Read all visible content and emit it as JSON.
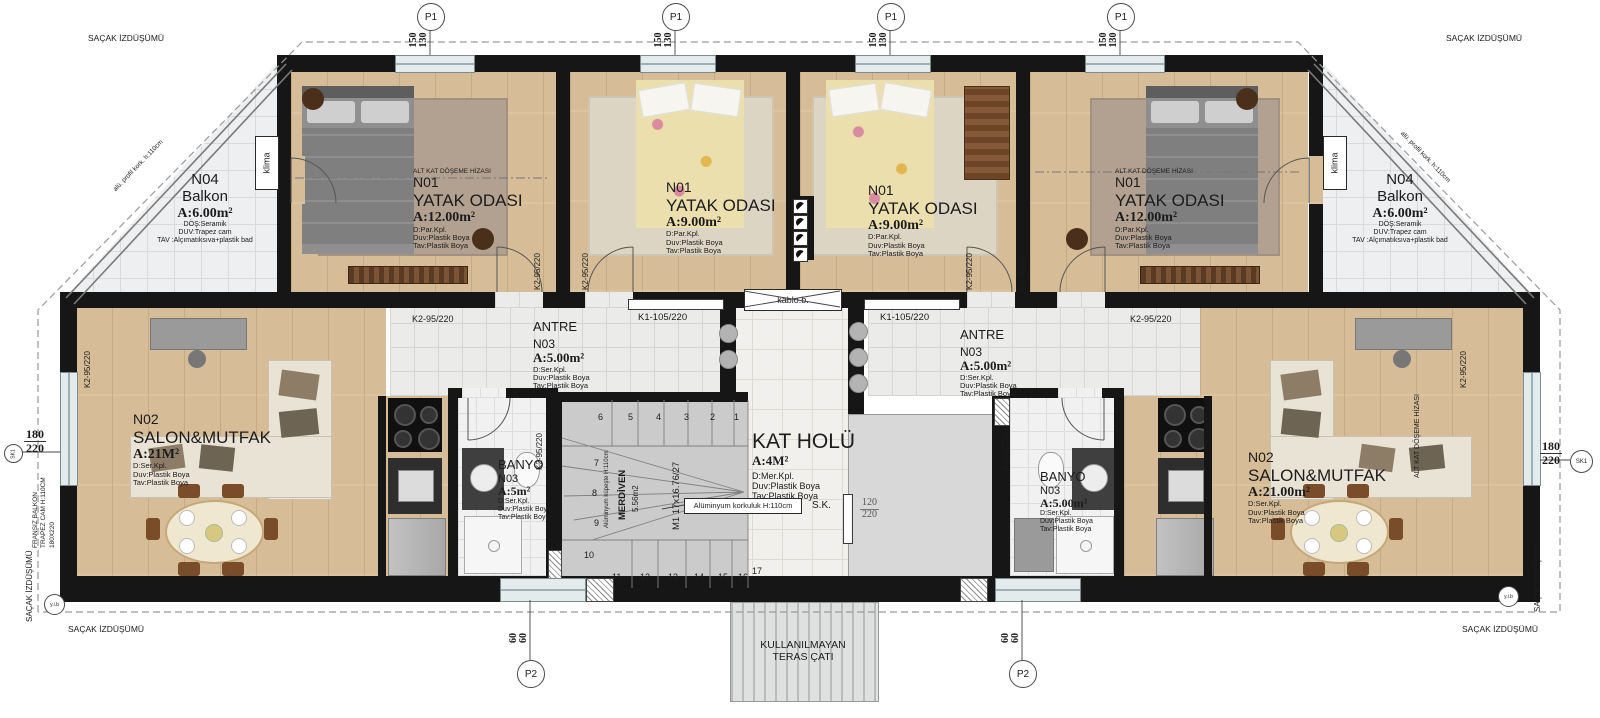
{
  "colors": {
    "wall": "#161616",
    "wood_floor": "#d6bd97",
    "tile": "#edeff0",
    "stair_gray": "#cbcbcb",
    "window": "#e4ebed"
  },
  "eave_label": "SAÇAK İZDÜŞÜMÜ",
  "markers": {
    "p1": "P1",
    "p1_dim": {
      "top": "150",
      "bottom": "130"
    },
    "p2": "P2",
    "p2_dim": {
      "top": "60",
      "bottom": "60"
    },
    "sk": "SK1",
    "sk_dim": {
      "top": "180",
      "bottom": "220"
    },
    "yib": "y.i.b"
  },
  "doors": {
    "k2": "K2-95/220",
    "k1": "K1-105/220",
    "sk_label": "S.K.",
    "sk_w": "120",
    "sk_h": "220",
    "kablo": "kablo.b."
  },
  "rooms": {
    "balcony_left": {
      "no": "N04",
      "name": "Balkon",
      "area": "A:6.00m²",
      "f1": "DÖŞ:Seramik",
      "f2": "DUV:Trapez cam",
      "f3": "TAV :Alçımatıksıva+plastik bad"
    },
    "balcony_right": {
      "no": "N04",
      "name": "Balkon",
      "area": "A:6.00m²",
      "f1": "DÖŞ:Seramik",
      "f2": "DUV:Trapez cam",
      "f3": "TAV :Alçımatıksıva+plastik bad"
    },
    "bed_left": {
      "hiza": "ALT KAT DÖŞEME HİZASI",
      "no": "N01",
      "name": "YATAK ODASI",
      "area": "A:12.00m²",
      "f1": "D:Par.Kpl.",
      "f2": "Duv:Plastik Boya",
      "f3": "Tav:Plastik Boya"
    },
    "bed_mid_left": {
      "no": "N01",
      "name": "YATAK ODASI",
      "area": "A:9.00m²",
      "f1": "D:Par.Kpl.",
      "f2": "Duv:Plastik Boya",
      "f3": "Tav:Plastik Boya"
    },
    "bed_mid_right": {
      "no": "N01",
      "name": "YATAK ODASI",
      "area": "A:9.00m²",
      "f1": "D:Par.Kpl.",
      "f2": "Duv:Plastik Boya",
      "f3": "Tav:Plastik Boya"
    },
    "bed_right": {
      "hiza": "ALT KAT DÖŞEME HİZASI",
      "no": "N01",
      "name": "YATAK ODASI",
      "area": "A:12.00m²",
      "f1": "D:Par.Kpl.",
      "f2": "Duv:Plastik Boya",
      "f3": "Tav:Plastik Boya"
    },
    "antre_left": {
      "name": "ANTRE",
      "no": "N03",
      "area": "A:5.00m²",
      "f1": "D:Ser.Kpl.",
      "f2": "Duv:Plastik Boya",
      "f3": "Tav:Plastik Boya"
    },
    "antre_right": {
      "name": "ANTRE",
      "no": "N03",
      "area": "A:5.00m²",
      "f1": "D:Ser.Kpl.",
      "f2": "Duv:Plastik Boya",
      "f3": "Tav:Plastik Boya"
    },
    "hall": {
      "name": "KAT HOLÜ",
      "area": "A:4M²",
      "f1": "D:Mer.Kpl.",
      "f2": "Duv:Plastik Boya",
      "f3": "Tav:Plastik Boya"
    },
    "banyo_left": {
      "name": "BANYO",
      "no": "N03",
      "area": "A:5m²",
      "f1": "D:Ser.Kpl.",
      "f2": "Duv:Plastik Boya",
      "f3": "Tav:Plastik Boya"
    },
    "banyo_right": {
      "name": "BANYO",
      "no": "N03",
      "area": "A:5.00m²",
      "f1": "D:Ser.Kpl.",
      "f2": "Duv:Plastik Boya",
      "f3": "Tav:Plastik Boya"
    },
    "salon_left": {
      "no": "N02",
      "name": "SALON&MUTFAK",
      "area": "A:21M²",
      "f1": "D:Ser.Kpl.",
      "f2": "Duv:Plastik Boya",
      "f3": "Tav:Plastik Boya"
    },
    "salon_right": {
      "no": "N02",
      "name": "SALON&MUTFAK",
      "area": "A:21.00m²",
      "f1": "D:Ser.Kpl.",
      "f2": "Duv:Plastik Boya",
      "f3": "Tav:Plastik Boya"
    },
    "terrace": {
      "line1": "KULLANILMAYAN",
      "line2": "TERAS ÇATI"
    }
  },
  "stairs": {
    "numbers": [
      "1",
      "2",
      "3",
      "4",
      "5",
      "6",
      "7",
      "8",
      "9",
      "10",
      "11",
      "12",
      "13",
      "14",
      "15",
      "16",
      "17"
    ],
    "name": "MERDİVEN",
    "area": "5.56m2",
    "kupeste": "Alüminyum küpeşte H:110cm",
    "korkuluk": "Alüminyum korkuluk H:110cm",
    "m1": "M1 17x16.76/27"
  },
  "annotations": {
    "klima": "klima",
    "fransiz1": "FRANSIZ BALKON",
    "fransiz2": "TRAPEZ CAM H:110CM",
    "fransiz3": "180X220",
    "alt_kat": "ALT KAT DÖŞEME HİZASI",
    "alu_kork": "alü. profil kork. h:110cm"
  }
}
